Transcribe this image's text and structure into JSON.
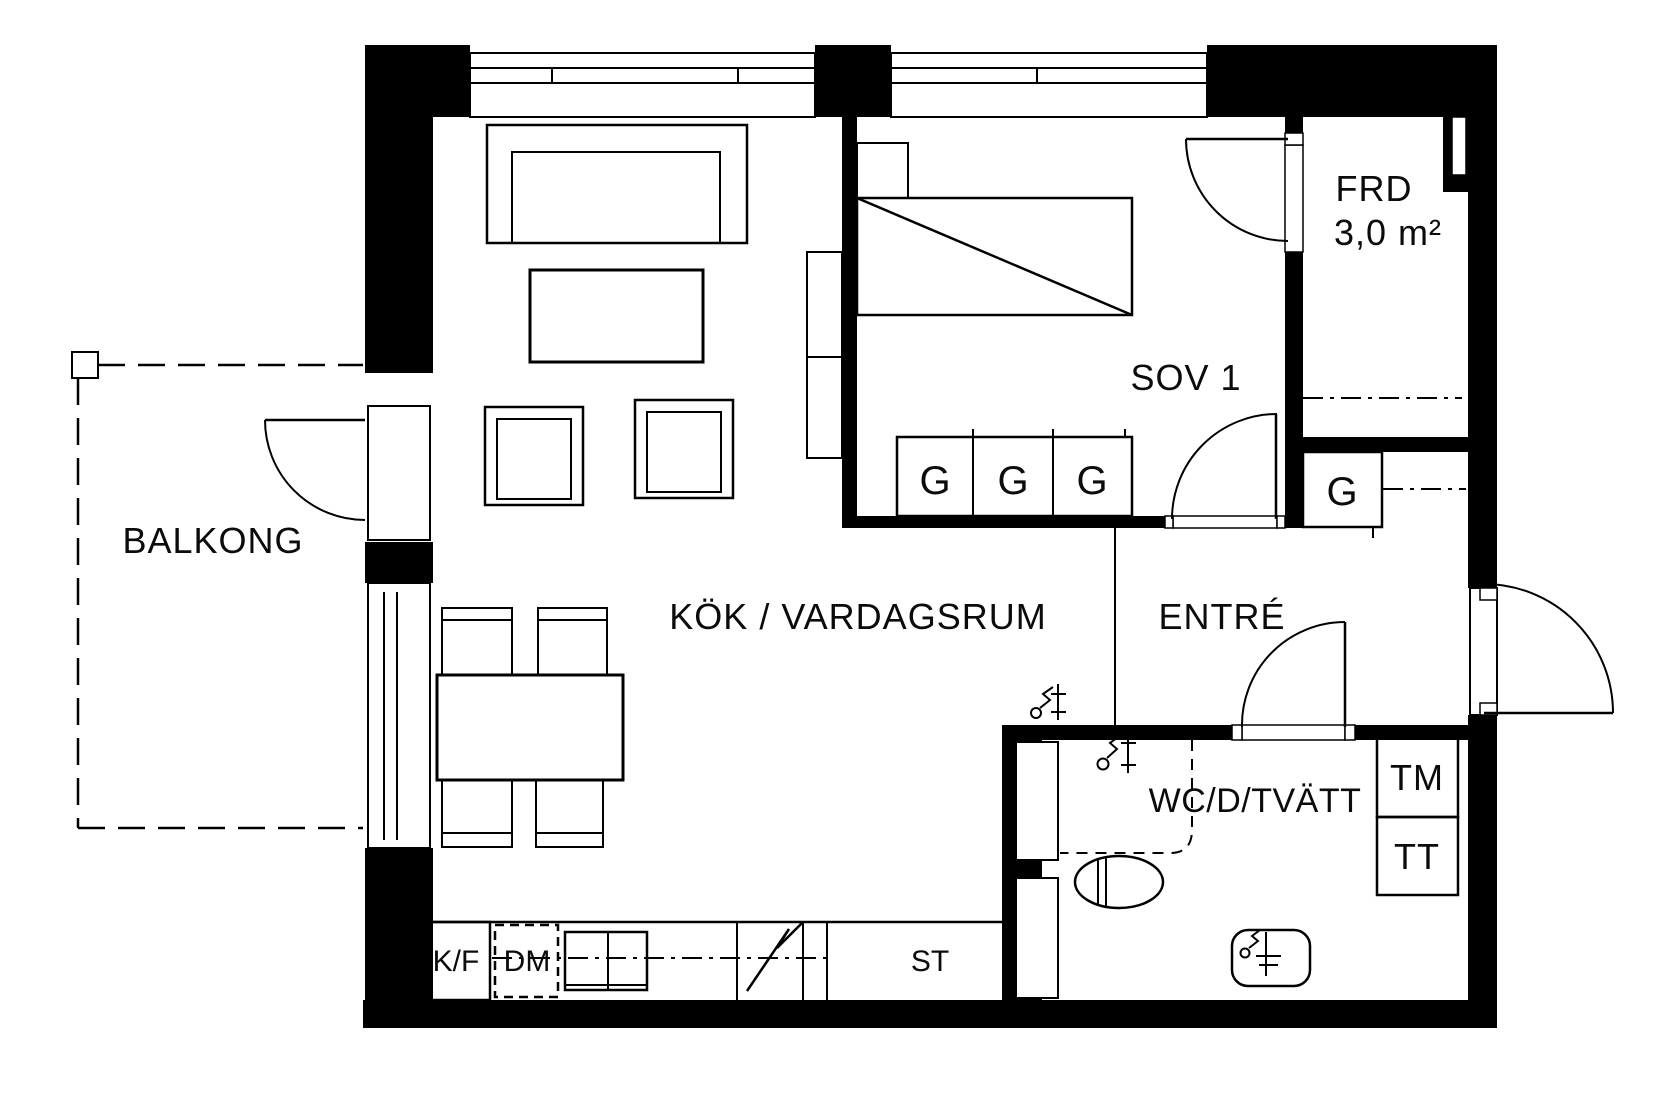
{
  "rooms": {
    "balcony": "BALKONG",
    "kitchen_living": "KÖK / VARDAGSRUM",
    "bedroom": "SOV 1",
    "entry": "ENTRÉ",
    "storage": "FRD",
    "storage_area": "3,0 m²",
    "bathroom": "WC/D/TVÄTT"
  },
  "fixtures": {
    "wardrobe": "G",
    "fridge_freezer": "K/F",
    "dishwasher": "DM",
    "cleaning_closet": "ST",
    "washing_machine": "TM",
    "tumble_dryer": "TT"
  },
  "colors": {
    "wall": "#000000",
    "background": "#ffffff"
  }
}
